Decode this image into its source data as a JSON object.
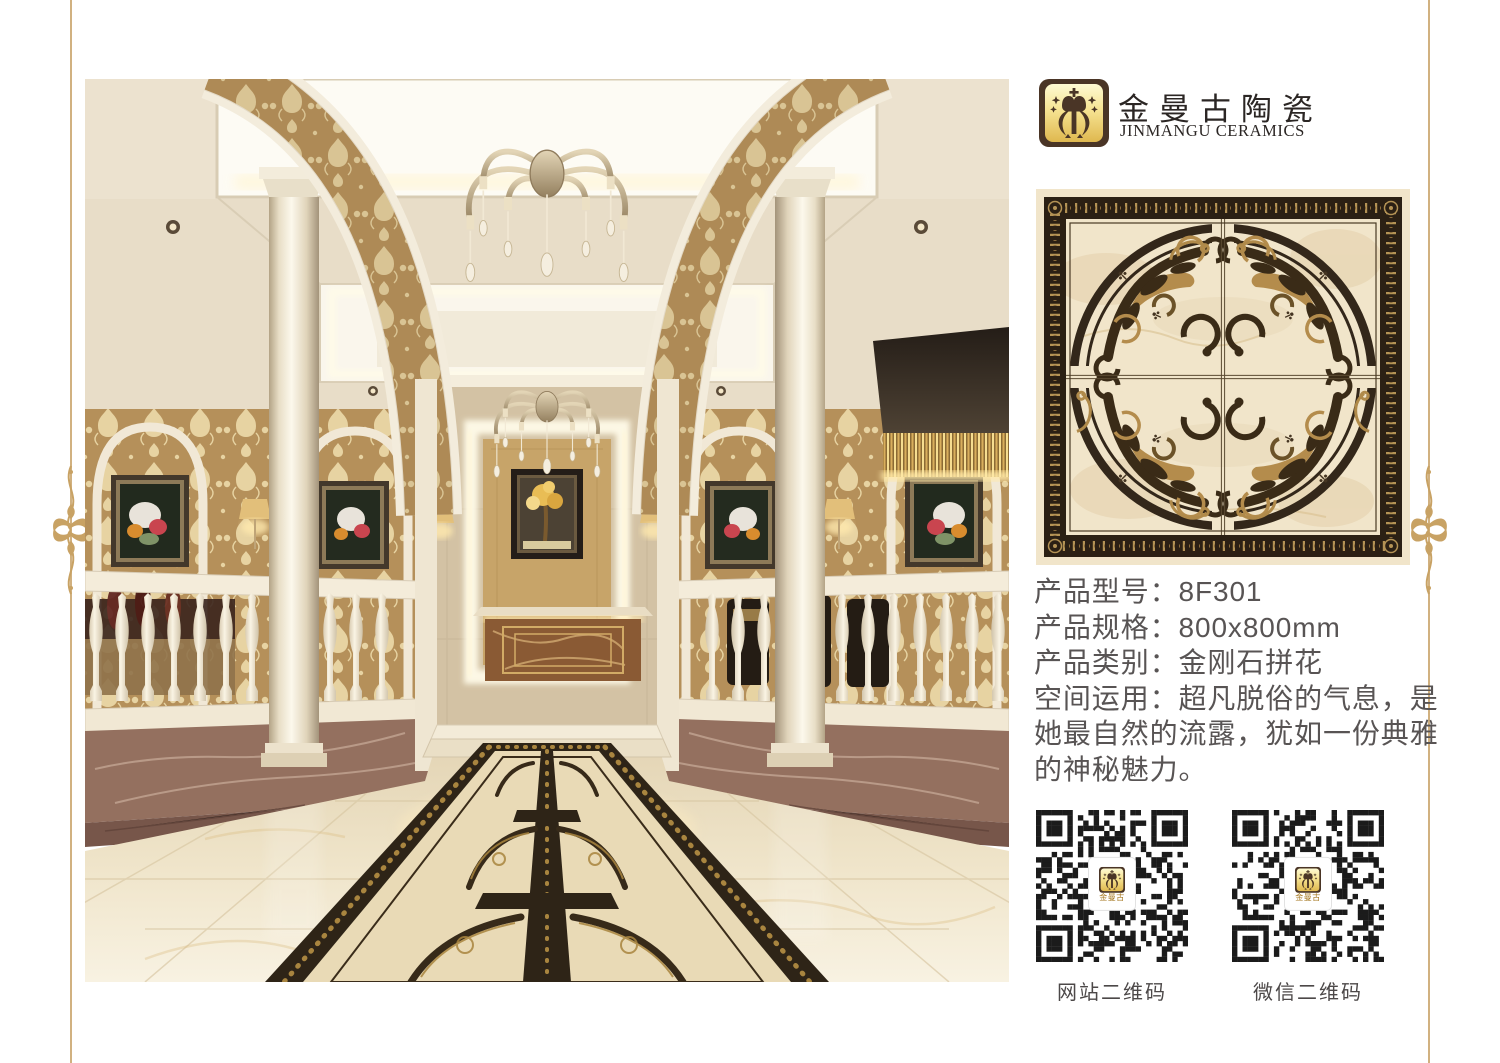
{
  "page": {
    "background": "#ffffff",
    "frame_color": "#c9a36a"
  },
  "brand": {
    "name_cn": "金曼古陶瓷",
    "name_en": "JINMANGU CERAMICS",
    "logo_dark": "#4a3526",
    "logo_gold_light": "#fdf6c8",
    "logo_gold_deep": "#e2bd55"
  },
  "product": {
    "fields": [
      {
        "text": "产品型号：8F301"
      },
      {
        "text": "产品规格：800x800mm"
      },
      {
        "text": "产品类别：金刚石拼花"
      },
      {
        "text": "空间运用：超凡脱俗的气息，是她最自然的流露，犹如一份典雅的神秘魅力。"
      }
    ]
  },
  "qr_codes": [
    {
      "label": "网站二维码",
      "center_text": "金曼古"
    },
    {
      "label": "微信二维码",
      "center_text": "金曼古"
    }
  ],
  "tile": {
    "accent_dark": "#2e2315",
    "accent_tan": "#b08a4a",
    "field": "#f0e4c9"
  }
}
